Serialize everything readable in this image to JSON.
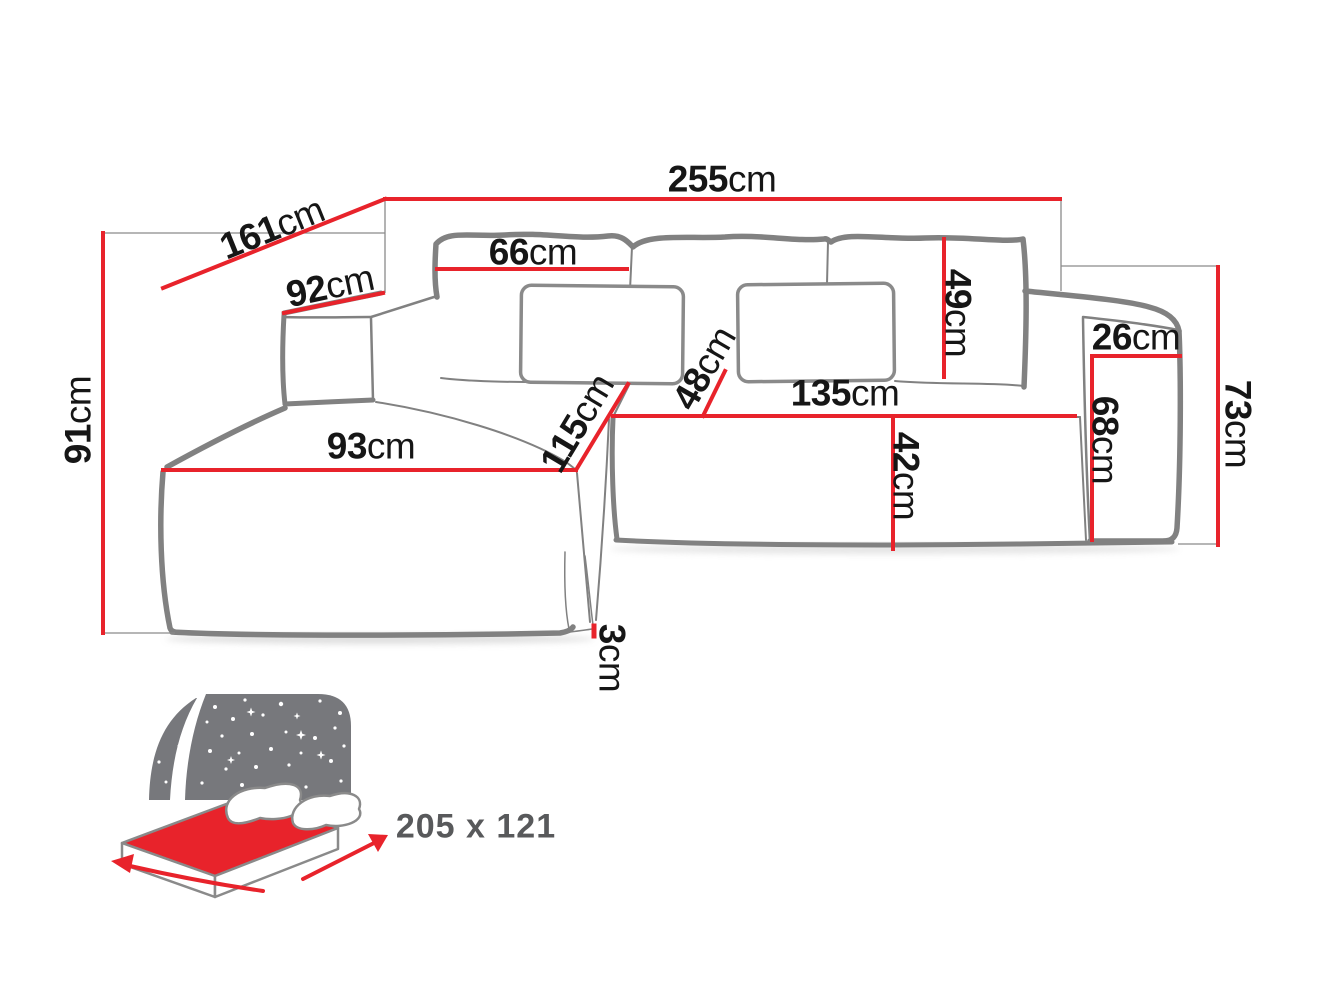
{
  "diagram": {
    "title": "corner-sofa-dimension-diagram",
    "unit": "cm",
    "dimensions": {
      "d255": {
        "value": "255",
        "unit": "cm"
      },
      "d161": {
        "value": "161",
        "unit": "cm"
      },
      "d92": {
        "value": "92",
        "unit": "cm"
      },
      "d66": {
        "value": "66",
        "unit": "cm"
      },
      "d49": {
        "value": "49",
        "unit": "cm"
      },
      "d26": {
        "value": "26",
        "unit": "cm"
      },
      "d68": {
        "value": "68",
        "unit": "cm"
      },
      "d73": {
        "value": "73",
        "unit": "cm"
      },
      "d91": {
        "value": "91",
        "unit": "cm"
      },
      "d93": {
        "value": "93",
        "unit": "cm"
      },
      "d115": {
        "value": "115",
        "unit": "cm"
      },
      "d48": {
        "value": "48",
        "unit": "cm"
      },
      "d135": {
        "value": "135",
        "unit": "cm"
      },
      "d42": {
        "value": "42",
        "unit": "cm"
      },
      "d3": {
        "value": "3",
        "unit": "cm"
      }
    },
    "sleeping_area": {
      "label": "205 x 121"
    },
    "colors": {
      "dimension_red": "#e8232b",
      "outline_gray": "#818181",
      "reference_gray": "#8a8a8a",
      "icon_gray": "#77787c",
      "label_black": "#161616",
      "sleeping_text_gray": "#58595b"
    }
  }
}
